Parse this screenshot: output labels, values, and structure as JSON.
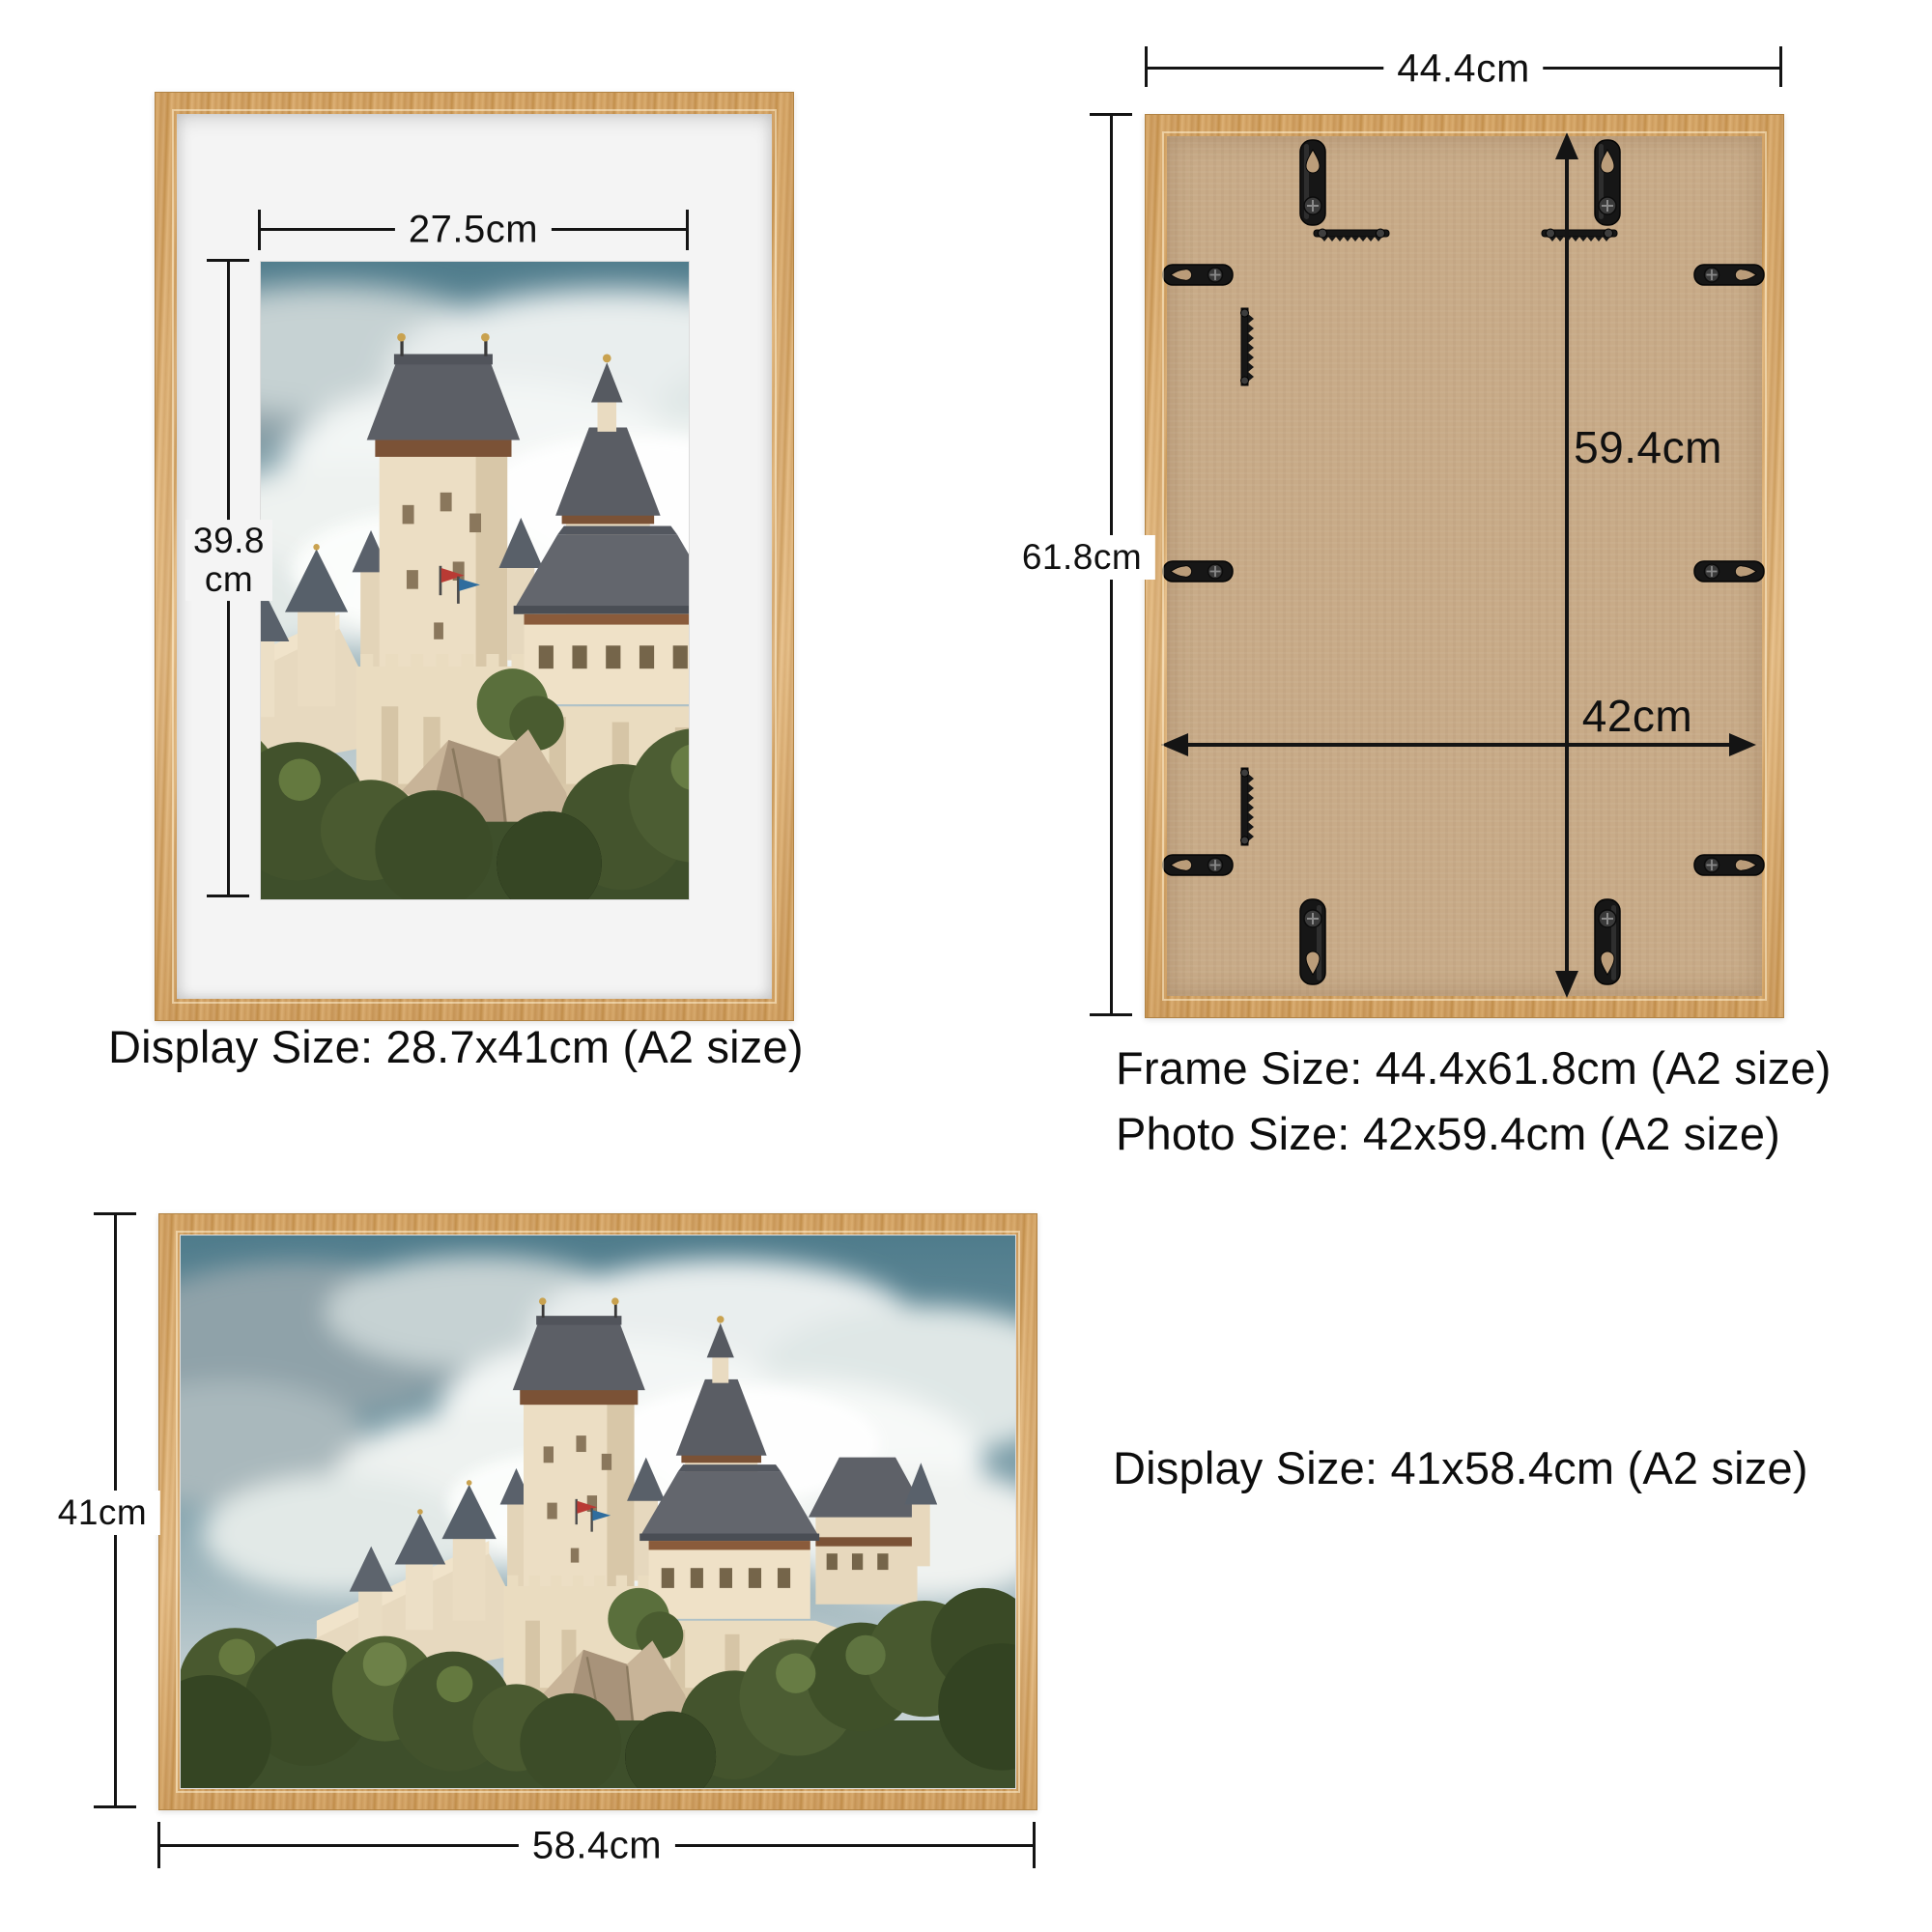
{
  "product": "wooden picture frame dimension infographic",
  "frames": {
    "front_portrait": {
      "width_label": "27.5cm",
      "height_label_line1": "39.8",
      "height_label_line2": "cm",
      "caption": "Display Size: 28.7x41cm (A2 size)"
    },
    "back": {
      "outer_width_label": "44.4cm",
      "outer_height_label": "61.8cm",
      "inner_height_label": "59.4cm",
      "inner_width_label": "42cm",
      "caption_line1": "Frame Size: 44.4x61.8cm (A2 size)",
      "caption_line2": "Photo Size: 42x59.4cm (A2 size)"
    },
    "front_landscape": {
      "height_label": "41cm",
      "width_label": "58.4cm",
      "caption": "Display Size: 41x58.4cm (A2 size)"
    }
  },
  "icons": {
    "hanging_hook": "teardrop-keyhole hanging hook",
    "sawtooth_hanger": "sawtooth hanger bar",
    "sawtooth_strip": "vertical sawtooth strip",
    "flip_tab": "flip turn-button tab"
  },
  "colors": {
    "wood": "#d8a766",
    "wood_light": "#e6ba7e",
    "board": "#c8ab88",
    "mat": "#f4f4f4",
    "line": "#141414",
    "text": "#0d0d0d",
    "sky": "#52808f",
    "roof": "#5b5e64",
    "wall": "#ecdec4",
    "foliage": "#46572e"
  }
}
